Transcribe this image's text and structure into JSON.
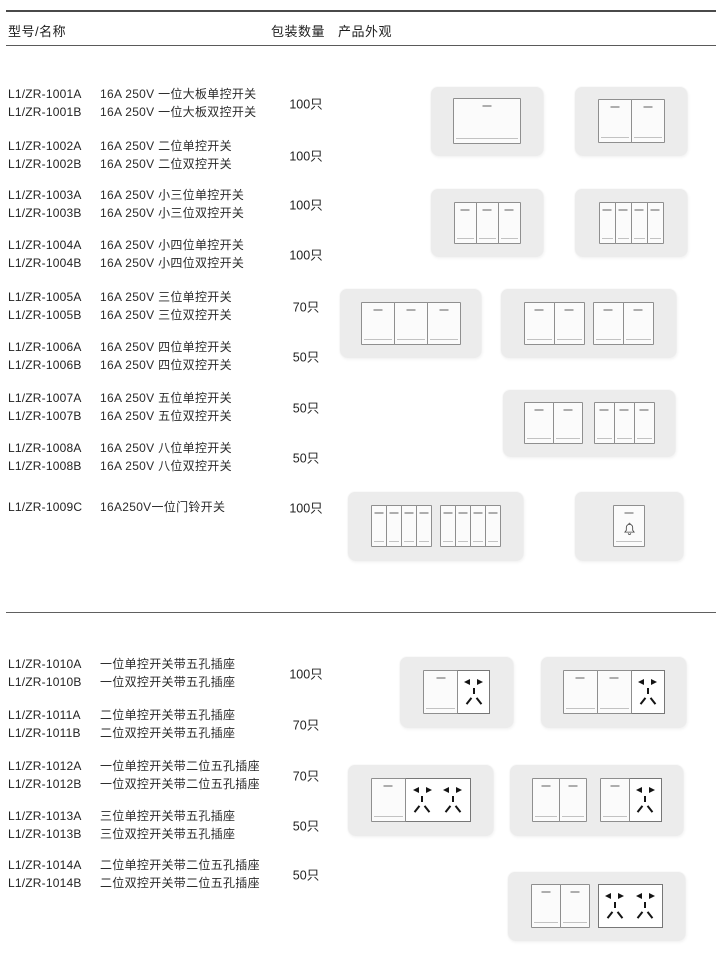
{
  "header": {
    "model": "型号/名称",
    "qty": "包装数量",
    "appearance": "产品外观"
  },
  "rows": [
    {
      "model_a": "L1/ZR-1001A",
      "desc_a": "16A 250V 一位大板单控开关",
      "model_b": "L1/ZR-1001B",
      "desc_b": "16A 250V 一位大板双控开关",
      "qty": "100只"
    },
    {
      "model_a": "L1/ZR-1002A",
      "desc_a": "16A 250V 二位单控开关",
      "model_b": "L1/ZR-1002B",
      "desc_b": "16A 250V 二位双控开关",
      "qty": "100只"
    },
    {
      "model_a": "L1/ZR-1003A",
      "desc_a": "16A 250V 小三位单控开关",
      "model_b": "L1/ZR-1003B",
      "desc_b": "16A 250V 小三位双控开关",
      "qty": "100只"
    },
    {
      "model_a": "L1/ZR-1004A",
      "desc_a": "16A 250V 小四位单控开关",
      "model_b": "L1/ZR-1004B",
      "desc_b": "16A 250V 小四位双控开关",
      "qty": "100只"
    },
    {
      "model_a": "L1/ZR-1005A",
      "desc_a": "16A 250V 三位单控开关",
      "model_b": "L1/ZR-1005B",
      "desc_b": "16A 250V 三位双控开关",
      "qty": "70只"
    },
    {
      "model_a": "L1/ZR-1006A",
      "desc_a": "16A 250V 四位单控开关",
      "model_b": "L1/ZR-1006B",
      "desc_b": "16A 250V 四位双控开关",
      "qty": "50只"
    },
    {
      "model_a": "L1/ZR-1007A",
      "desc_a": "16A 250V 五位单控开关",
      "model_b": "L1/ZR-1007B",
      "desc_b": "16A 250V 五位双控开关",
      "qty": "50只"
    },
    {
      "model_a": "L1/ZR-1008A",
      "desc_a": "16A 250V 八位单控开关",
      "model_b": "L1/ZR-1008B",
      "desc_b": "16A 250V 八位双控开关",
      "qty": "50只"
    },
    {
      "model_a": "L1/ZR-1009C",
      "desc_a": "16A250V一位门铃开关",
      "qty": "100只"
    },
    {
      "model_a": "L1/ZR-1010A",
      "desc_a": "一位单控开关带五孔插座",
      "model_b": "L1/ZR-1010B",
      "desc_b": "一位双控开关带五孔插座",
      "qty": "100只"
    },
    {
      "model_a": "L1/ZR-1011A",
      "desc_a": "二位单控开关带五孔插座",
      "model_b": "L1/ZR-1011B",
      "desc_b": "二位双控开关带五孔插座",
      "qty": "70只"
    },
    {
      "model_a": "L1/ZR-1012A",
      "desc_a": "一位单控开关带二位五孔插座",
      "model_b": "L1/ZR-1012B",
      "desc_b": "一位双控开关带二位五孔插座",
      "qty": "70只"
    },
    {
      "model_a": "L1/ZR-1013A",
      "desc_a": "三位单控开关带五孔插座",
      "model_b": "L1/ZR-1013B",
      "desc_b": "三位双控开关带五孔插座",
      "qty": "50只"
    },
    {
      "model_a": "L1/ZR-1014A",
      "desc_a": "二位单控开关带二位五孔插座",
      "model_b": "L1/ZR-1014B",
      "desc_b": "二位双控开关带二位五孔插座",
      "qty": "50只"
    }
  ],
  "plates": [
    {
      "name": "switch-1gang-large"
    },
    {
      "name": "switch-2gang"
    },
    {
      "name": "switch-3gang-small"
    },
    {
      "name": "switch-4gang-small"
    },
    {
      "name": "switch-3gang"
    },
    {
      "name": "switch-4gang-grouped"
    },
    {
      "name": "switch-5gang"
    },
    {
      "name": "switch-8gang"
    },
    {
      "name": "doorbell-switch"
    },
    {
      "name": "switch-1gang-with-5hole-socket"
    },
    {
      "name": "switch-2gang-with-5hole-socket"
    },
    {
      "name": "switch-1gang-with-double-5hole-socket"
    },
    {
      "name": "switch-3gang-with-5hole-socket"
    },
    {
      "name": "switch-2gang-with-double-5hole-socket"
    }
  ],
  "colors": {
    "plate_bg": "#ececec",
    "rocker_bg": "#fbfbfb",
    "pin": "#141414",
    "rule": "#4a4a4a"
  }
}
